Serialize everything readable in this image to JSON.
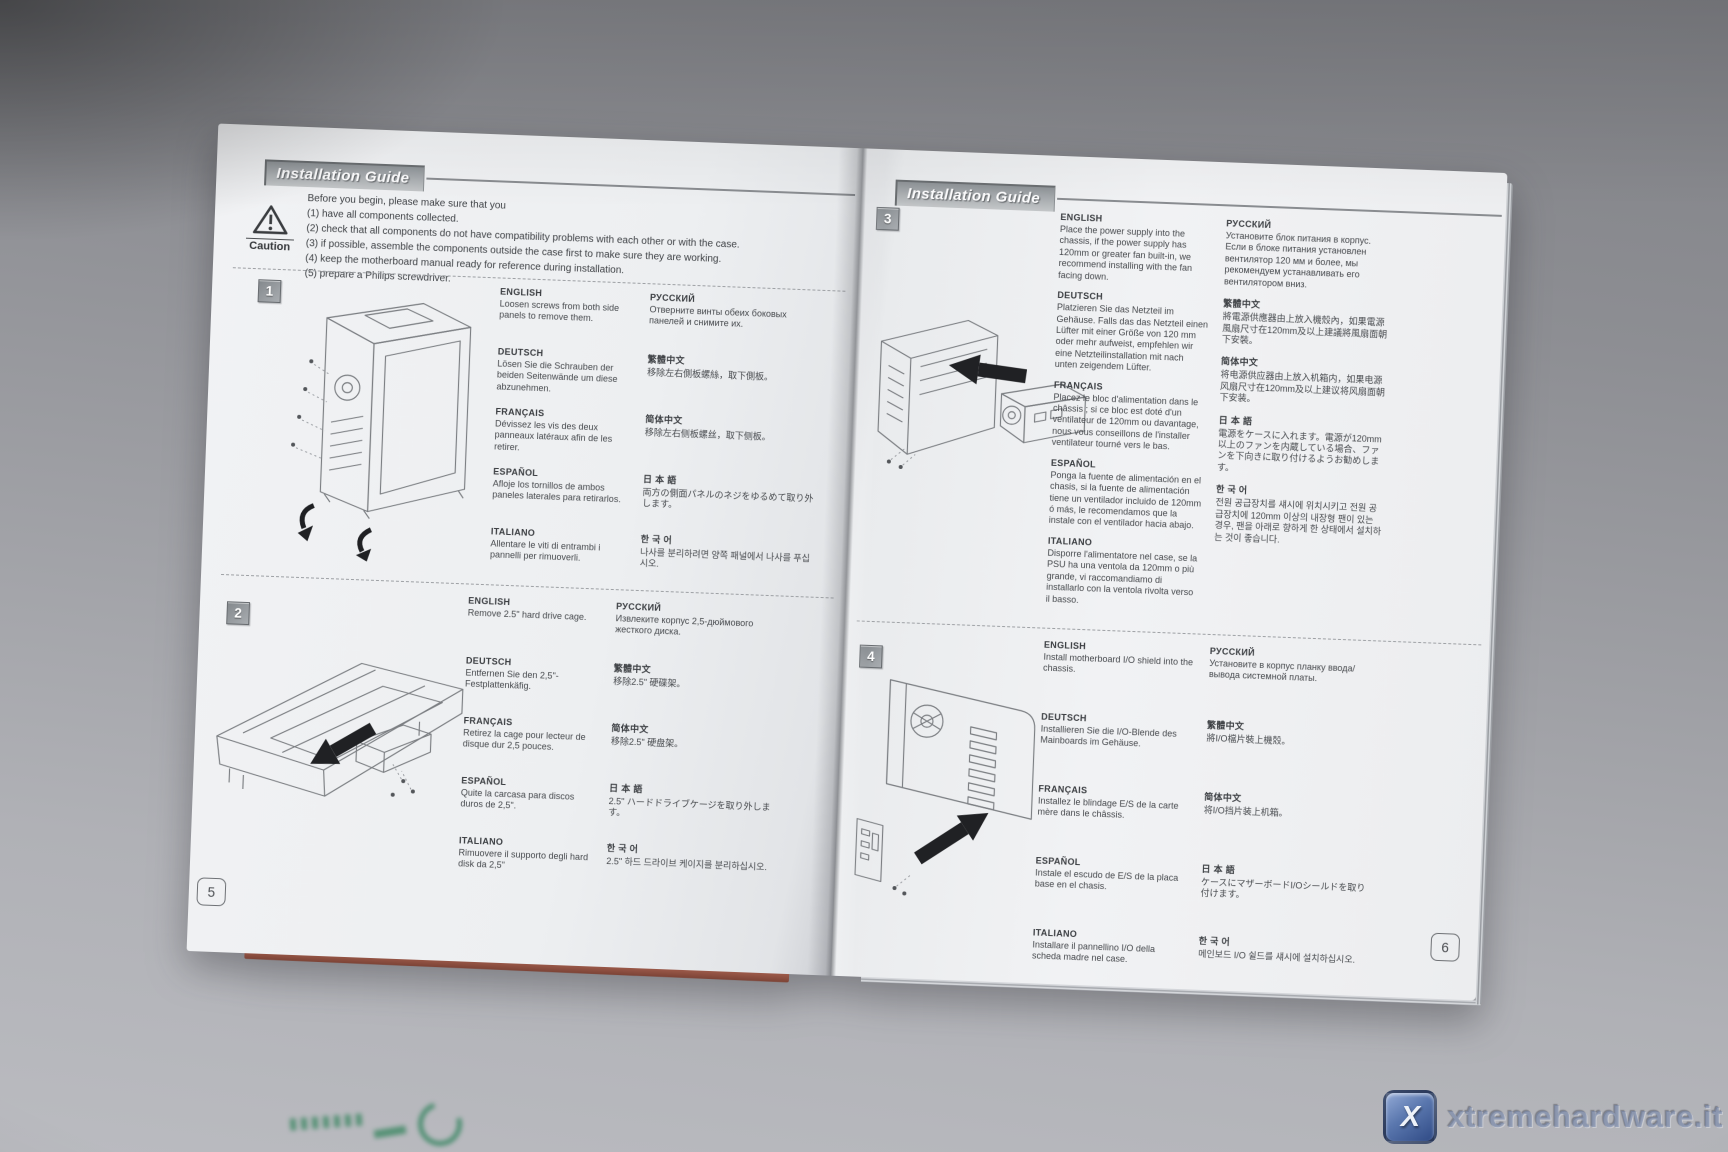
{
  "booklet": {
    "header_title": "Installation Guide",
    "caution": {
      "label": "Caution",
      "intro": "Before you begin, please make sure that you",
      "items": [
        "(1) have all components collected.",
        "(2) check that all components do not have compatibility problems with each other or with the case.",
        "(3) if possible, assemble the components outside the case first to make sure they are working.",
        "(4) keep the motherboard manual ready for reference during installation.",
        "(5) prepare a Philips screwdriver."
      ]
    },
    "page_numbers": [
      "5",
      "6"
    ],
    "steps": [
      {
        "number": "1",
        "col1": [
          {
            "label": "ENGLISH",
            "text": "Loosen screws from both side panels to remove them."
          },
          {
            "label": "DEUTSCH",
            "text": "Lösen Sie die Schrauben der beiden Seitenwände um diese abzunehmen."
          },
          {
            "label": "FRANÇAIS",
            "text": "Dévissez les vis des deux panneaux latéraux afin de les retirer."
          },
          {
            "label": "ESPAÑOL",
            "text": "Afloje los tornillos de ambos paneles laterales para retirarlos."
          },
          {
            "label": "ITALIANO",
            "text": "Allentare le viti di entrambi i pannelli per rimuoverli."
          }
        ],
        "col2": [
          {
            "label": "РУССКИЙ",
            "text": "Отверните винты обеих боковых панелей и снимите их."
          },
          {
            "label": "繁體中文",
            "text": "移除左右側板螺絲，取下側板。"
          },
          {
            "label": "简体中文",
            "text": "移除左右侧板螺丝，取下侧板。"
          },
          {
            "label": "日 本 語",
            "text": "両方の側面パネルのネジをゆるめて取り外します。"
          },
          {
            "label": "한 국 어",
            "text": "나사를 분리하려면 양쪽 패널에서 나사를 푸십시오."
          }
        ]
      },
      {
        "number": "2",
        "col1": [
          {
            "label": "ENGLISH",
            "text": "Remove 2.5\" hard drive cage."
          },
          {
            "label": "DEUTSCH",
            "text": "Entfernen Sie den 2,5\"-Festplattenkäfig."
          },
          {
            "label": "FRANÇAIS",
            "text": "Retirez la cage pour lecteur de disque dur 2,5 pouces."
          },
          {
            "label": "ESPAÑOL",
            "text": "Quite la carcasa para discos duros de 2,5\"."
          },
          {
            "label": "ITALIANO",
            "text": "Rimuovere il supporto degli hard disk da 2,5\""
          }
        ],
        "col2": [
          {
            "label": "РУССКИЙ",
            "text": "Извлеките корпус 2,5-дюймового жесткого диска."
          },
          {
            "label": "繁體中文",
            "text": "移除2.5\" 硬碟架。"
          },
          {
            "label": "简体中文",
            "text": "移除2.5\" 硬盘架。"
          },
          {
            "label": "日 本 語",
            "text": "2.5\" ハードドライブケージを取り外します。"
          },
          {
            "label": "한 국 어",
            "text": "2.5\" 하드 드라이브 케이지를 분리하십시오."
          }
        ]
      },
      {
        "number": "3",
        "col1": [
          {
            "label": "ENGLISH",
            "text": "Place the power supply into the chassis, if the power supply has 120mm or greater fan built-in, we recommend installing with the fan facing down."
          },
          {
            "label": "DEUTSCH",
            "text": "Platzieren Sie das Netzteil im Gehäuse. Falls das das Netzteil einen Lüfter mit einer Größe von 120 mm oder mehr aufweist, empfehlen wir eine Netzteilinstallation mit nach unten zeigendem Lüfter."
          },
          {
            "label": "FRANÇAIS",
            "text": "Placez le bloc d'alimentation dans le châssis ; si ce bloc est doté d'un ventilateur de 120mm ou davantage, nous vous conseillons de l'installer ventilateur tourné vers le bas."
          },
          {
            "label": "ESPAÑOL",
            "text": "Ponga la fuente de alimentación en el chasis, si la fuente de alimentación tiene un ventilador incluido de 120mm ó más, le recomendamos que la instale con el ventilador hacia abajo."
          },
          {
            "label": "ITALIANO",
            "text": "Disporre l'alimentatore nel case, se la PSU ha una ventola da 120mm o più grande, vi raccomandiamo di installarlo con la ventola rivolta verso il basso."
          }
        ],
        "col2": [
          {
            "label": "РУССКИЙ",
            "text": "Установите блок питания в корпус. Если в блоке питания установлен вентилятор 120 мм и более, мы рекомендуем устанавливать его вентилятором вниз."
          },
          {
            "label": "繁體中文",
            "text": "將電源供應器由上放入機殼內，如果電源風扇尺寸在120mm及以上建議將風扇面朝下安裝。"
          },
          {
            "label": "简体中文",
            "text": "将电源供应器由上放入机箱内，如果电源风扇尺寸在120mm及以上建议将风扇面朝下安装。"
          },
          {
            "label": "日 本 語",
            "text": "電源をケースに入れます。電源が120mm以上のファンを内蔵している場合、ファンを下向きに取り付けるようお勧めします。"
          },
          {
            "label": "한 국 어",
            "text": "전원 공급장치를 섀시에 위치시키고 전원 공급장치에 120mm 이상의 내장형 팬이 있는 경우, 팬을 아래로 향하게 한 상태에서 설치하는 것이 좋습니다."
          }
        ]
      },
      {
        "number": "4",
        "col1": [
          {
            "label": "ENGLISH",
            "text": "Install motherboard I/O shield into the chassis."
          },
          {
            "label": "DEUTSCH",
            "text": "Installieren Sie die I/O-Blende des Mainboards im Gehäuse."
          },
          {
            "label": "FRANÇAIS",
            "text": "Installez le blindage E/S de la carte mère dans le châssis."
          },
          {
            "label": "ESPAÑOL",
            "text": "Instale el escudo de E/S de la placa base en el chasis."
          },
          {
            "label": "ITALIANO",
            "text": "Installare il pannellino I/O della scheda madre nel case."
          }
        ],
        "col2": [
          {
            "label": "РУССКИЙ",
            "text": "Установите в корпус планку ввода/вывода системной платы."
          },
          {
            "label": "繁體中文",
            "text": "將I/O檔片裝上機殼。"
          },
          {
            "label": "简体中文",
            "text": "将I/O挡片装上机箱。"
          },
          {
            "label": "日 本 語",
            "text": "ケースにマザーボードI/Oシールドを取り付けます。"
          },
          {
            "label": "한 국 어",
            "text": "메인보드 I/O 쉴드를 섀시에 설치하십시오."
          }
        ]
      }
    ]
  },
  "watermark": {
    "site": "xtremehardware.it",
    "icon_letter": "X"
  }
}
